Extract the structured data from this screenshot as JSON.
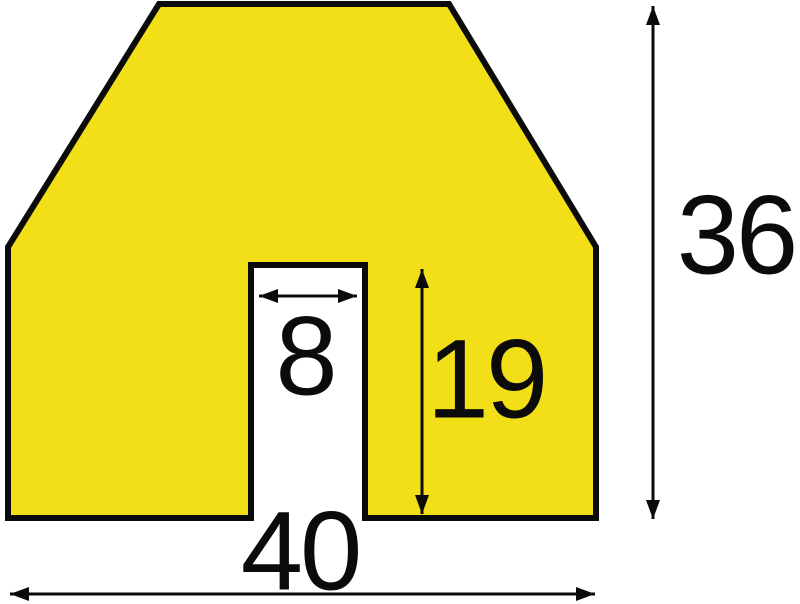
{
  "diagram": {
    "type": "technical-dimension-drawing",
    "subject": "impact protection profile cross-section with bottom notch",
    "dimensions": {
      "notch_width": "8",
      "notch_depth": "19",
      "overall_width": "40",
      "overall_height": "36"
    },
    "colors": {
      "profile_fill": "#F2DF17",
      "line": "#0B0B0B",
      "background": "#FFFFFF"
    }
  }
}
